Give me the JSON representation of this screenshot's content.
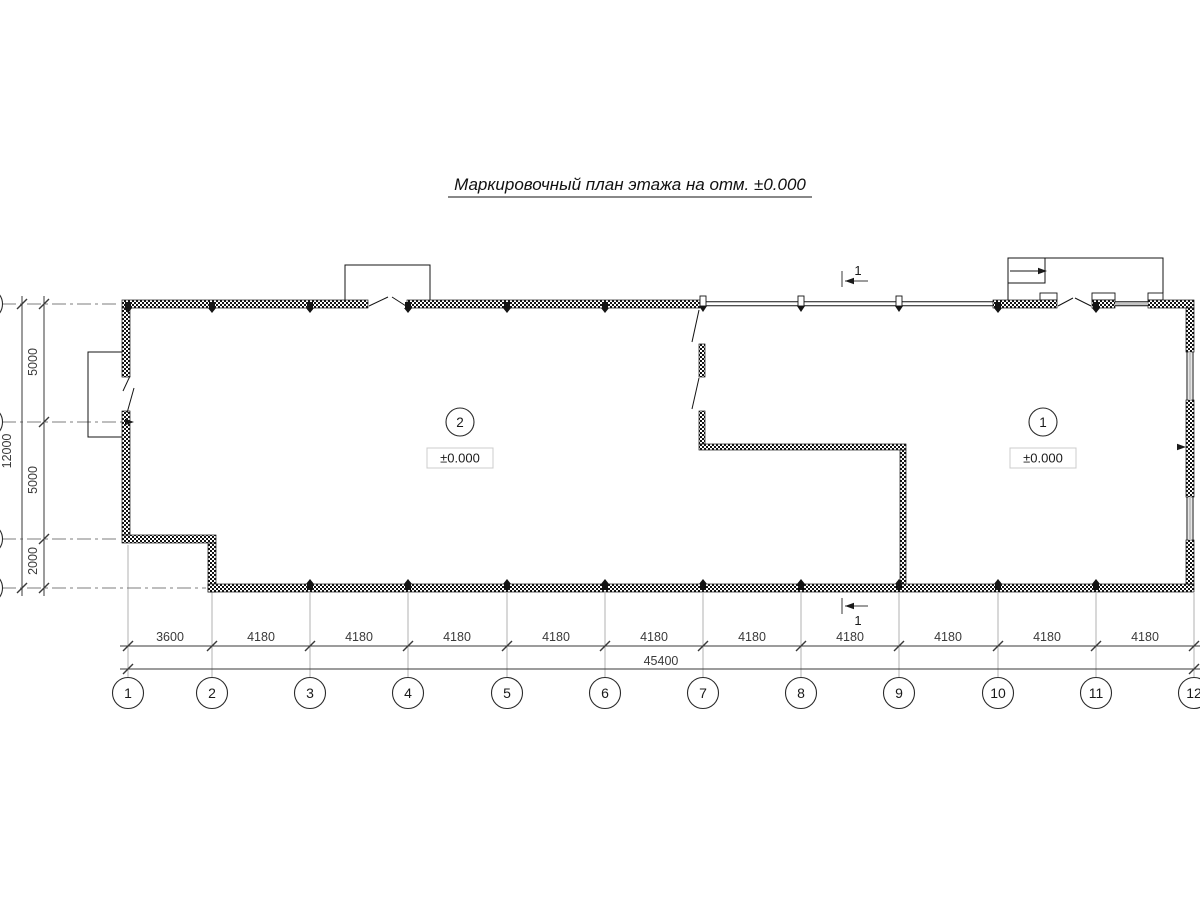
{
  "title": "Маркировочный план этажа на отм. ±0.000",
  "rooms": [
    {
      "number": "2",
      "elevation": "±0.000"
    },
    {
      "number": "1",
      "elevation": "±0.000"
    }
  ],
  "section_mark": {
    "label": "1"
  },
  "axes_bottom": {
    "labels": [
      "1",
      "2",
      "3",
      "4",
      "5",
      "6",
      "7",
      "8",
      "9",
      "10",
      "11",
      "12"
    ],
    "dims": [
      "3600",
      "4180",
      "4180",
      "4180",
      "4180",
      "4180",
      "4180",
      "4180",
      "4180",
      "4180",
      "4180"
    ],
    "total": "45400"
  },
  "dims_left": {
    "segments": [
      "5000",
      "5000",
      "2000"
    ],
    "total": "12000"
  },
  "colors": {
    "line": "#141414",
    "dim": "#3a3a3a",
    "grid": "#b0b0b0",
    "centerline": "#7d7d7d",
    "window_gray": "#c4c4c4",
    "background": "#ffffff"
  }
}
